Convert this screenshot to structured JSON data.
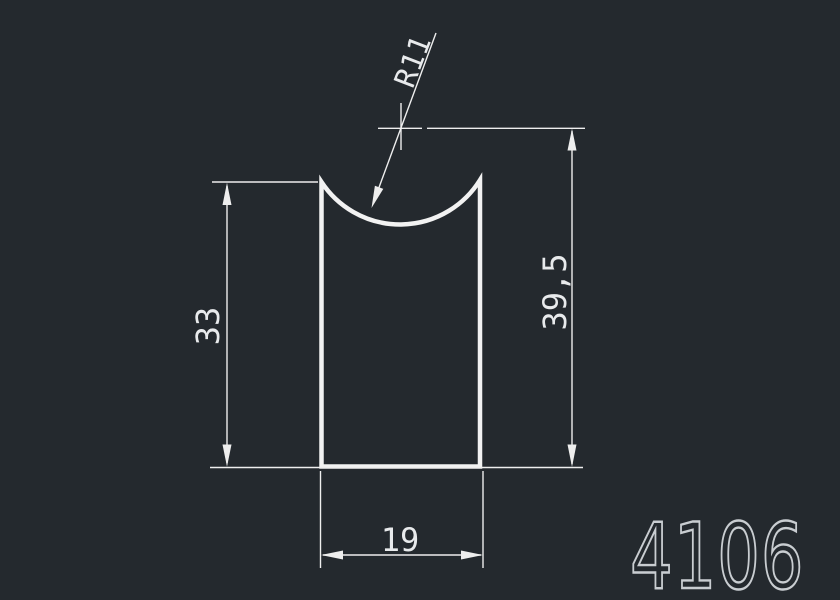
{
  "canvas": {
    "background": "#24292e",
    "line_color": "#f2f2f2",
    "dim_line_color": "#eeeeee",
    "dim_text_color": "#e8eaec",
    "part_number_color": "#c9cdd1"
  },
  "drawing": {
    "part_number": "4106",
    "profile_description": "rectangular extrusion profile with concave arc top",
    "dimensions": {
      "radius": "R11",
      "height_left": "33",
      "height_right": "39,5",
      "width_bottom": "19"
    }
  }
}
